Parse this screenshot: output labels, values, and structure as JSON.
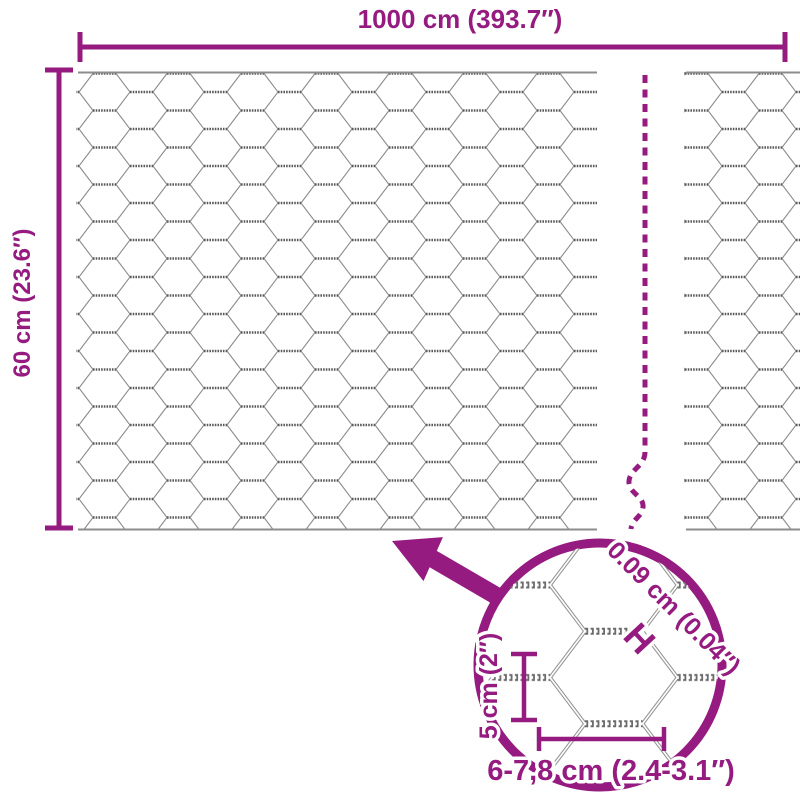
{
  "diagram": {
    "width_label": "1000 cm (393.7″)",
    "height_label": "60 cm (23.6″)",
    "detail": {
      "wire_thickness_label": "0.09 cm (0.04″)",
      "wire_thickness_marker": "H",
      "mesh_height_label": "5 cm (2″)",
      "mesh_width_label": "6-7,8 cm (2.4-3.1″)"
    },
    "colors": {
      "accent": "#951B81",
      "mesh_line": "#8C8C8C",
      "mesh_twist": "#5A5A5A",
      "background": "#FFFFFF"
    }
  }
}
